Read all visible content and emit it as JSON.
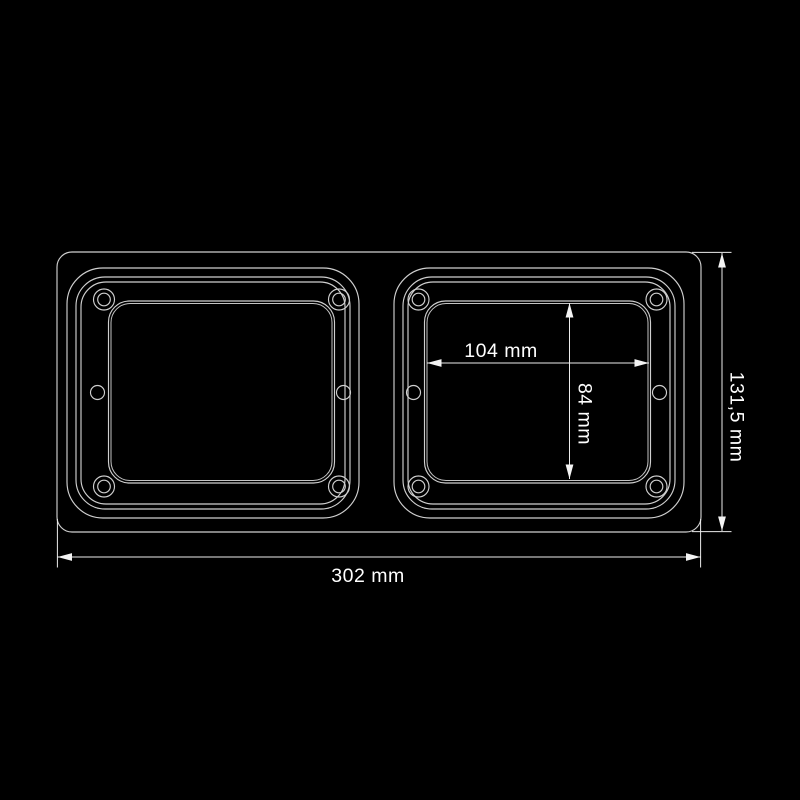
{
  "diagram": {
    "type": "technical-dimension-drawing",
    "background_color": "#000000",
    "line_color": "#cfcfcf",
    "dimension_line_color": "#ececec",
    "text_color": "#ffffff",
    "dimensions": {
      "inner_opening_width": "104 mm",
      "inner_opening_height": "84 mm",
      "overall_height": "131,5 mm",
      "overall_width": "302 mm"
    }
  }
}
